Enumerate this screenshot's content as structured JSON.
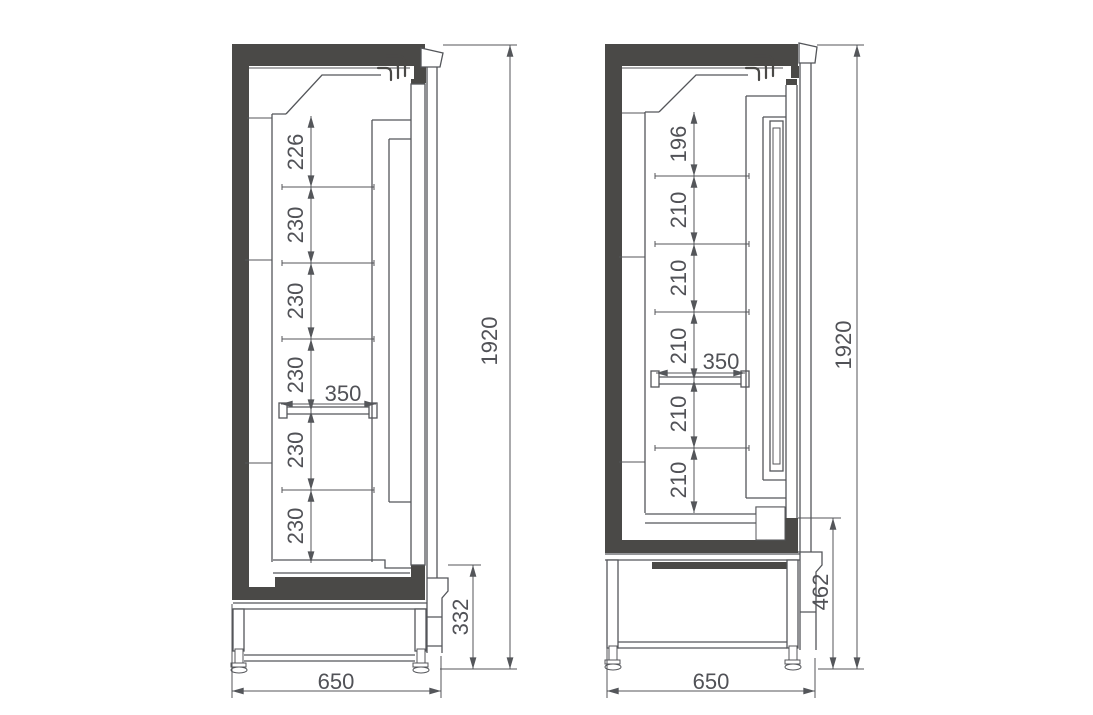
{
  "colors": {
    "wall_fill": "#4a4947",
    "line": "#54565a",
    "dim_text": "#515257"
  },
  "views": {
    "left": {
      "label": "left-cabinet-section",
      "overall_height": "1920",
      "overall_width": "650",
      "base_height": "332",
      "shelf_depth": "350",
      "shelf_spacings": [
        "226",
        "230",
        "230",
        "230",
        "230",
        "230"
      ]
    },
    "right": {
      "label": "right-cabinet-section",
      "overall_height": "1920",
      "overall_width": "650",
      "base_height": "462",
      "shelf_depth": "350",
      "shelf_spacings": [
        "196",
        "210",
        "210",
        "210",
        "210",
        "210"
      ]
    }
  }
}
